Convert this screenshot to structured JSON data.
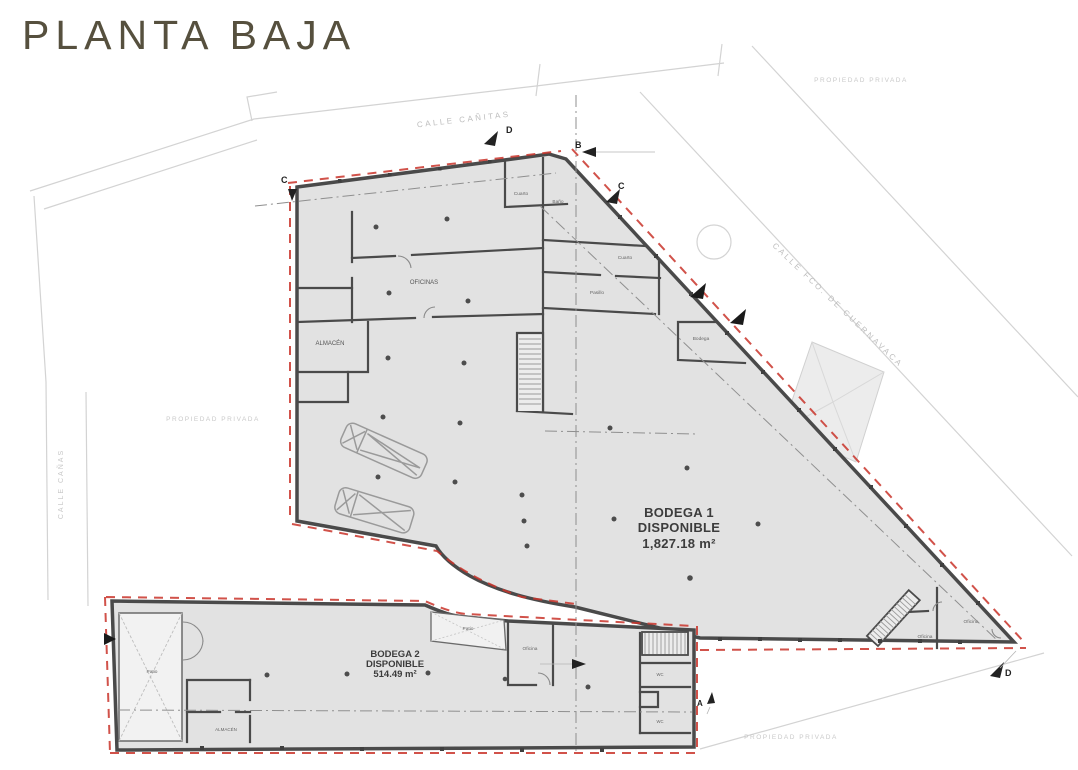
{
  "title": "PLANTA BAJA",
  "units": {
    "bodega1": {
      "name": "BODEGA 1",
      "status": "DISPONIBLE",
      "area": "1,827.18 m²"
    },
    "bodega2": {
      "name": "BODEGA 2",
      "status": "DISPONIBLE",
      "area": "514.49 m²"
    }
  },
  "rooms": {
    "oficinas": "OFICINAS",
    "almacen": "ALMACÉN",
    "cuarto_top": "Cuarto",
    "bano_top": "Baño",
    "cuarto_mid": "Cuarto",
    "pasillo": "Pasillo",
    "bodega_small": "Bodega",
    "oficina_left": "Oficina",
    "oficina_right": "Oficina",
    "patio_left": "Patio",
    "patio_mid": "Patio",
    "oficina_b2": "Oficina",
    "almacen_b2": "ALMACÉN",
    "wc_upper": "WC",
    "wc_lower": "WC"
  },
  "streets": {
    "top": "CALLE CAÑITAS",
    "left": "CALLE CAÑAS",
    "right": "CALLE FCO. DE CUERNAVACA"
  },
  "notes": {
    "top_right": "PROPIEDAD PRIVADA",
    "left": "PROPIEDAD PRIVADA",
    "bottom": "PROPIEDAD PRIVADA"
  },
  "markers": {
    "b_top": "B",
    "c_top": "C",
    "d_top": "D",
    "c_left": "C",
    "d_bottom": "D",
    "a_bottom": "A"
  },
  "colors": {
    "wall": "#4a4a4a",
    "floor": "#e2e2e2",
    "floor_light": "#f2f2f2",
    "red_boundary": "#c9342a",
    "title": "#56503e",
    "label_dark": "#3c3c3c",
    "room_label": "#5a5a5a",
    "faint": "#c3c3c3"
  }
}
